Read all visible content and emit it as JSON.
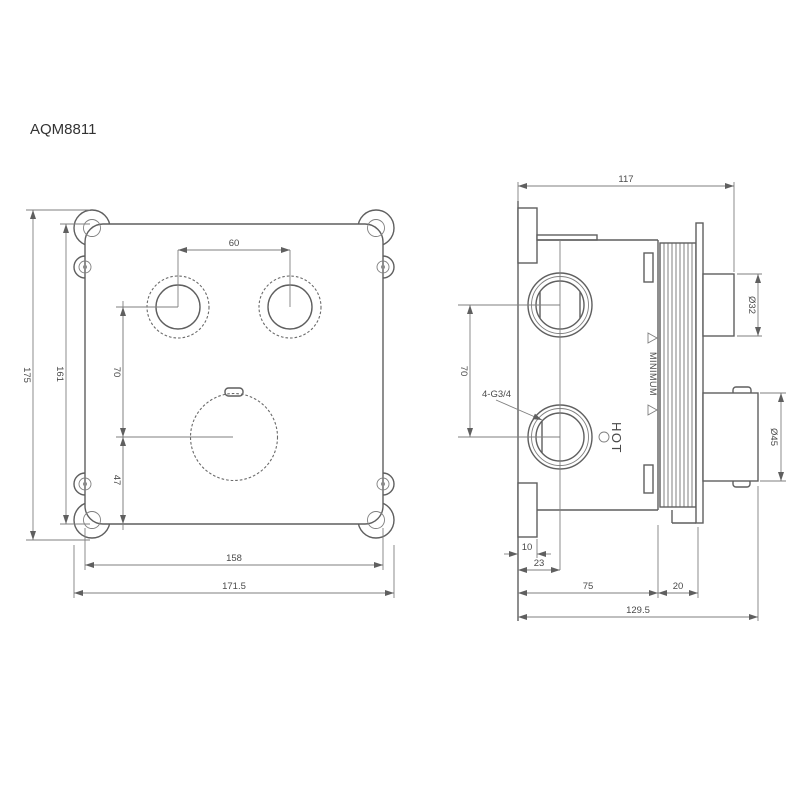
{
  "title": "AQM8811",
  "colors": {
    "line": "#5f5f5f",
    "dim_line": "#7f7f7f",
    "background": "#ffffff"
  },
  "front_view": {
    "dims": {
      "knob_spacing": "60",
      "upper_offset": "70",
      "lower_offset": "47",
      "plate_height": "161",
      "overall_height": "175",
      "plate_width": "158",
      "overall_width": "171.5"
    }
  },
  "side_view": {
    "dims": {
      "depth": "117",
      "port_spacing": "70",
      "thread_label": "4-G3/4",
      "tab_depth": "10",
      "port_center_depth": "23",
      "body_depth": "75",
      "collar_depth": "20",
      "overall_depth": "129.5",
      "small_knob_dia": "Ø32",
      "large_knob_dia": "Ø45"
    },
    "labels": {
      "hot": "HOT",
      "minimum": "MINIMUM"
    }
  }
}
